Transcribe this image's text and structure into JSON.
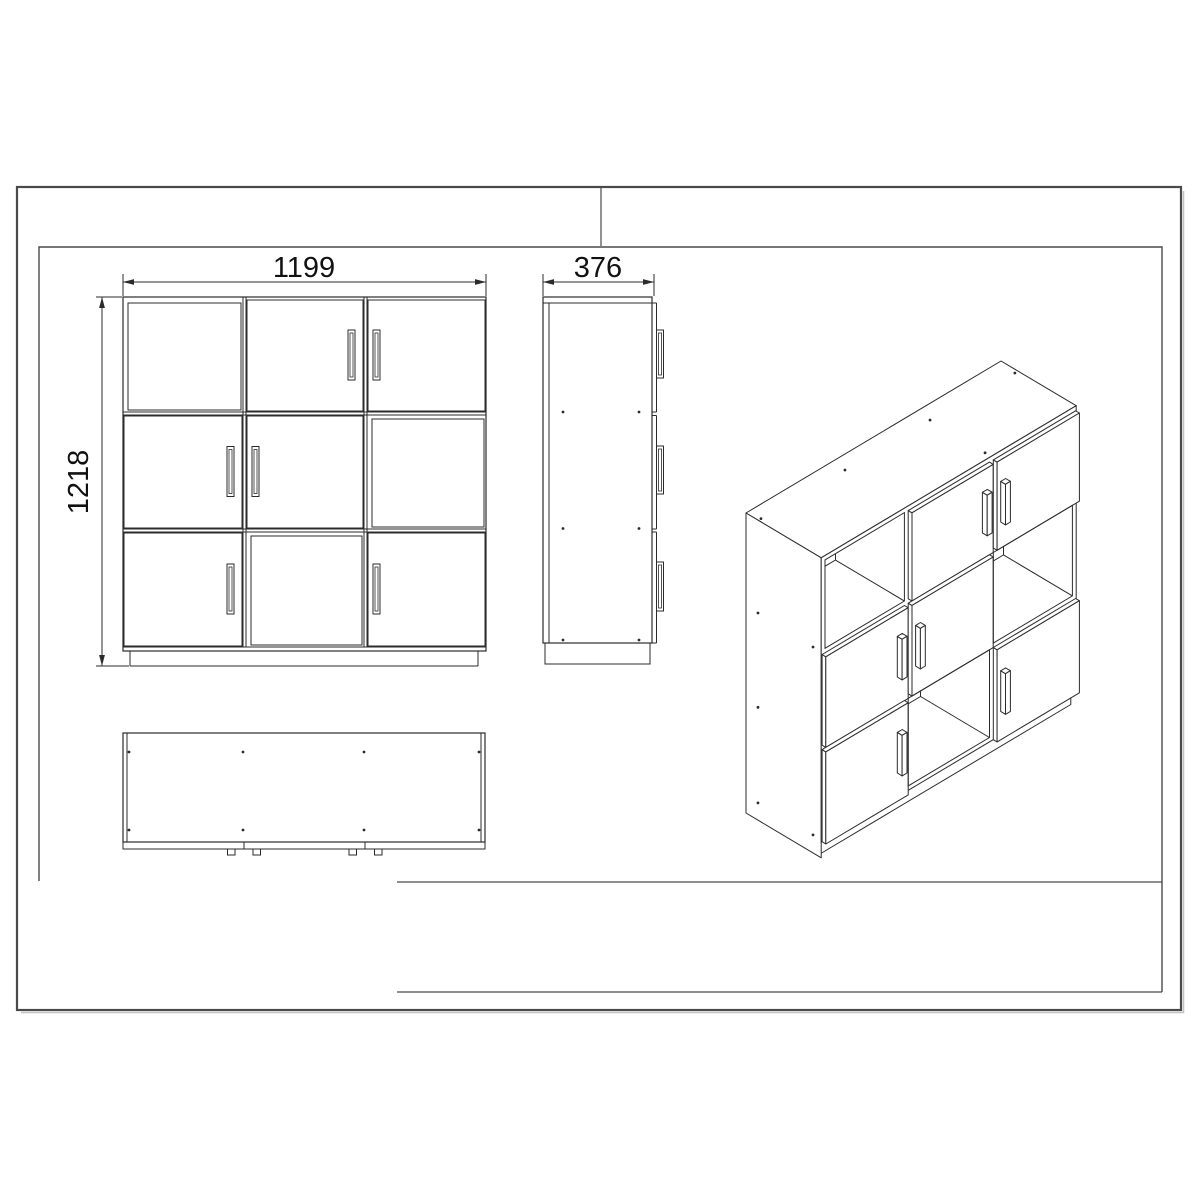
{
  "sheet": {
    "background": "#ffffff",
    "frame_color": "#4a4a4a",
    "line_color": "#2b2b2b",
    "shadow_color": "#c4c4c4"
  },
  "labels": {
    "front_width": "1199",
    "front_height": "1218",
    "side_depth": "376"
  },
  "cabinet": {
    "width_mm": 1199,
    "depth_mm": 376,
    "height_mm": 1218,
    "layout": [
      [
        "open",
        "door",
        "door"
      ],
      [
        "door",
        "door",
        "open"
      ],
      [
        "door",
        "open",
        "door"
      ]
    ],
    "handles": [
      [
        null,
        "right",
        "left"
      ],
      [
        "right",
        "left",
        null
      ],
      [
        "right",
        null,
        "left"
      ]
    ]
  }
}
